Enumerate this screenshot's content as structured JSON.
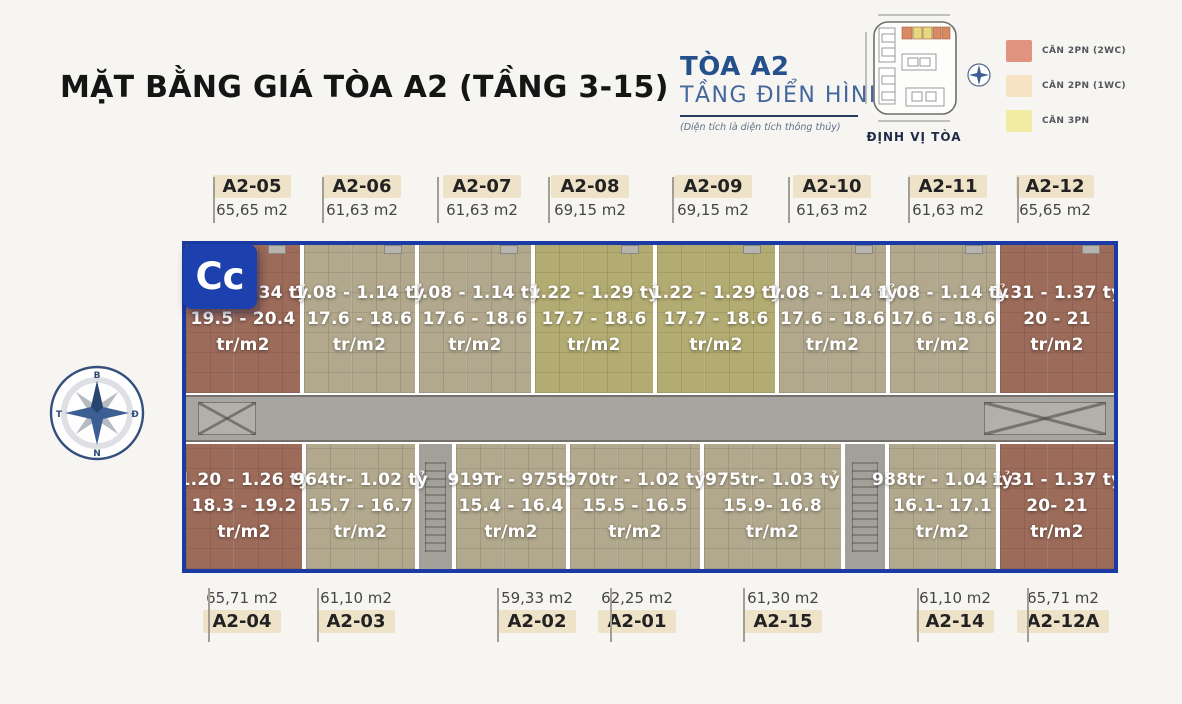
{
  "page": {
    "title": "MẶT BẰNG GIÁ TÒA A2 (TẦNG 3-15)",
    "badge": "Cc",
    "background": "#f6f5f2"
  },
  "brand": {
    "line1": "TÒA A2",
    "line2": "TẦNG ĐIỂN HÌNH",
    "note": "(Diện tích là diện tích thông thủy)",
    "mini_map_label": "ĐỊNH VỊ TÒA",
    "accent": "#24508c"
  },
  "legend": {
    "items": [
      {
        "label": "CĂN 2PN (2WC)",
        "color": "#e0937e"
      },
      {
        "label": "CĂN 2PN (1WC)",
        "color": "#f7e2c4"
      },
      {
        "label": "CĂN 3PN",
        "color": "#f0eca1"
      }
    ]
  },
  "compass": {
    "north": "B",
    "east": "Đ",
    "south": "N",
    "west": "T"
  },
  "floor_plan": {
    "border_color": "#1b3aa3",
    "unit_price_suffix": "tr/m2",
    "unit_colors": {
      "brick": "#9c6b5a",
      "beige": "#b1a88d",
      "olive": "#b3ac72"
    },
    "top_units": [
      {
        "id": "A2-05",
        "area": "65,65 m2",
        "price": "1.28 - 1.34 tỷ",
        "unit_price": "19.5 - 20.4",
        "type": "brick"
      },
      {
        "id": "A2-06",
        "area": "61,63 m2",
        "price": "1.08 - 1.14 tỷ",
        "unit_price": "17.6 - 18.6",
        "type": "beige"
      },
      {
        "id": "A2-07",
        "area": "61,63 m2",
        "price": "1.08 - 1.14 tỷ",
        "unit_price": "17.6 - 18.6",
        "type": "beige"
      },
      {
        "id": "A2-08",
        "area": "69,15 m2",
        "price": "1.22 - 1.29 tỷ",
        "unit_price": "17.7 - 18.6",
        "type": "olive"
      },
      {
        "id": "A2-09",
        "area": "69,15 m2",
        "price": "1.22 - 1.29 tỷ",
        "unit_price": "17.7 - 18.6",
        "type": "olive"
      },
      {
        "id": "A2-10",
        "area": "61,63 m2",
        "price": "1.08 - 1.14 tỷ",
        "unit_price": "17.6 - 18.6",
        "type": "beige"
      },
      {
        "id": "A2-11",
        "area": "61,63 m2",
        "price": "1.08 - 1.14 tỷ",
        "unit_price": "17.6 - 18.6",
        "type": "beige"
      },
      {
        "id": "A2-12",
        "area": "65,65 m2",
        "price": "1.31 - 1.37 tỷ",
        "unit_price": "20 - 21",
        "type": "brick"
      }
    ],
    "bottom_units": [
      {
        "id": "A2-04",
        "area": "65,71 m2",
        "price": "1.20 - 1.26 tỷ",
        "unit_price": "18.3 - 19.2",
        "type": "brick"
      },
      {
        "id": "A2-03",
        "area": "61,10 m2",
        "price": "964tr- 1.02 tỷ",
        "unit_price": "15.7 - 16.7",
        "type": "beige"
      },
      {
        "id": "A2-02",
        "area": "59,33 m2",
        "price": "919Tr - 975tr",
        "unit_price": "15.4 - 16.4",
        "type": "beige"
      },
      {
        "id": "A2-01",
        "area": "62,25 m2",
        "price": "970tr - 1.02 tỷ",
        "unit_price": "15.5 - 16.5",
        "type": "beige"
      },
      {
        "id": "A2-15",
        "area": "61,30 m2",
        "price": "975tr- 1.03 tỷ",
        "unit_price": "15.9- 16.8",
        "type": "beige"
      },
      {
        "id": "A2-14",
        "area": "61,10 m2",
        "price": "988tr - 1.04 tỷ",
        "unit_price": "16.1- 17.1",
        "type": "beige"
      },
      {
        "id": "A2-12A",
        "area": "65,71 m2",
        "price": "1.31 - 1.37 tỷ",
        "unit_price": "20- 21",
        "type": "brick"
      }
    ]
  }
}
